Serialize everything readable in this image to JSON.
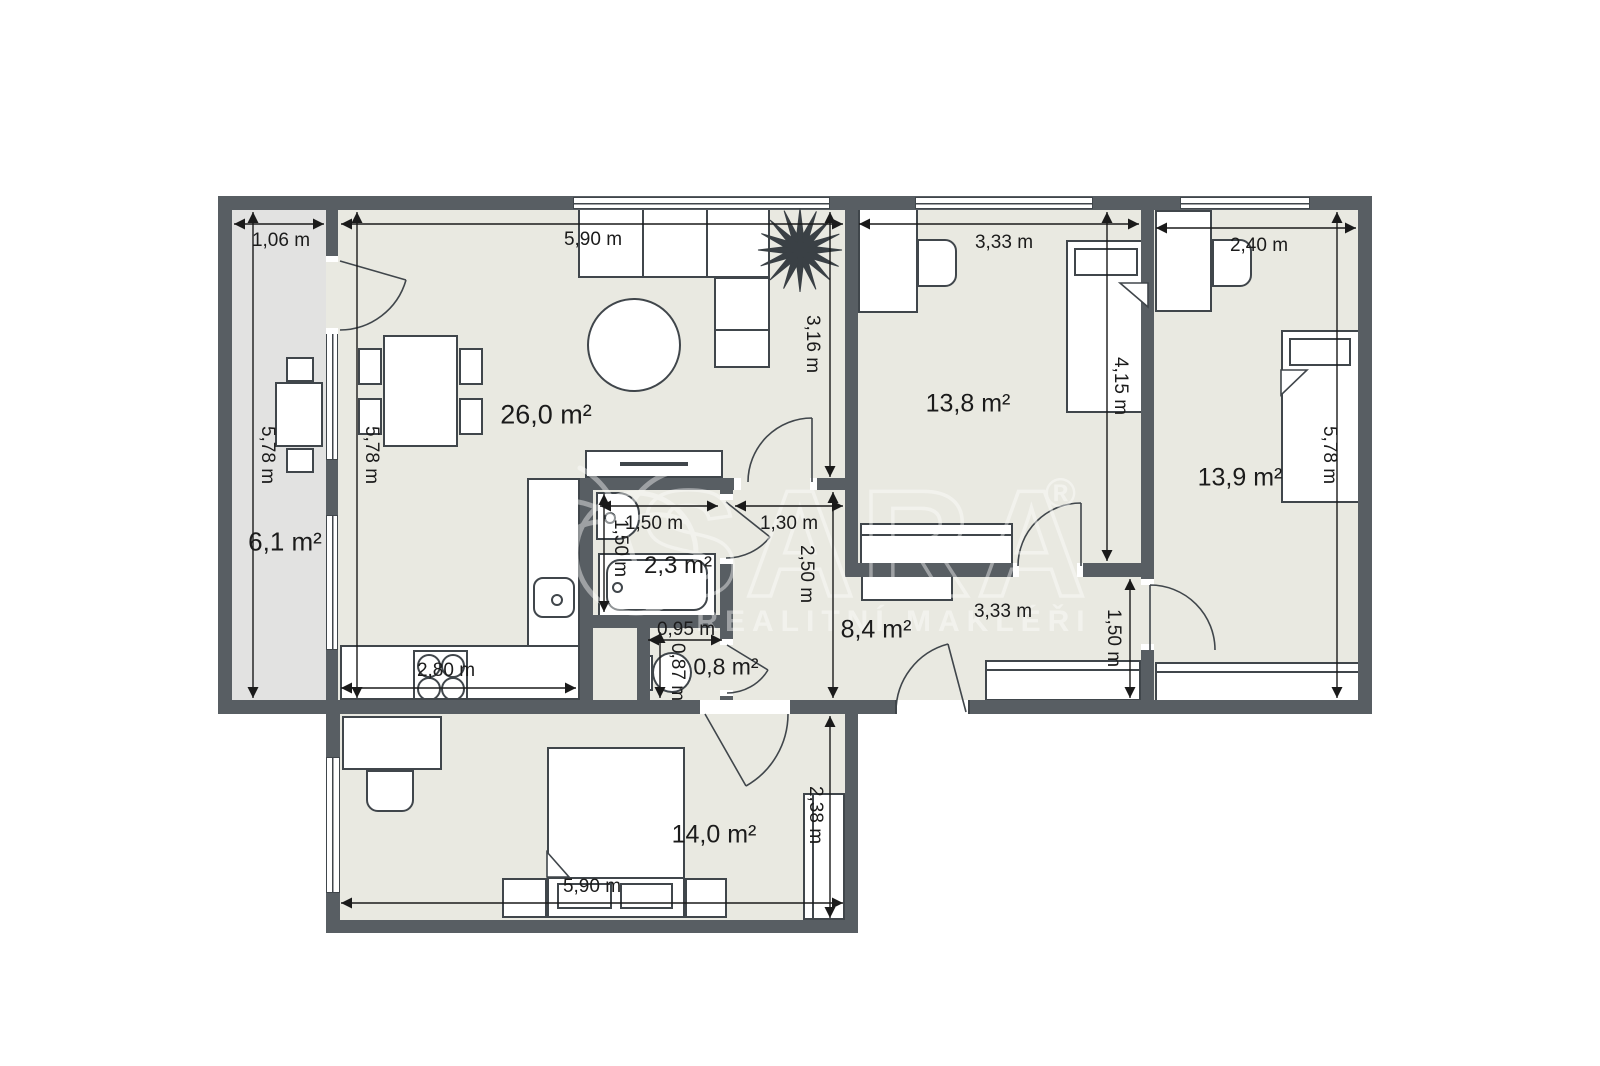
{
  "watermark": {
    "brand": "SARA",
    "registered_mark": "®",
    "tagline": "REALITNÍ MAKLÉŘI"
  },
  "colors": {
    "wall": "#585e63",
    "floor": "#e9e9e1",
    "balcony_floor": "#e2e2e1",
    "furniture_outline": "#40464b",
    "dimension_ink": "#1a1a1a",
    "watermark_ink": "#ffffff",
    "background": "#ffffff"
  },
  "rooms": {
    "balcony": {
      "area": "6,1 m²",
      "dim_width": "1,06 m",
      "dim_height": "5,78 m"
    },
    "living_kitchen": {
      "area": "26,0 m²",
      "dim_width": "5,90 m",
      "dim_height": "5,78 m",
      "dim_right_height": "3,16 m",
      "dim_kitchen_width": "2,80 m"
    },
    "bedroom_top_left": {
      "area": "13,8 m²",
      "dim_width": "3,33 m",
      "dim_height": "4,15 m"
    },
    "bedroom_top_right": {
      "area": "13,9 m²",
      "dim_width": "2,40 m",
      "dim_height": "5,78 m"
    },
    "bathroom": {
      "area": "2,3 m²",
      "dim_width": "1,50 m",
      "dim_height": "1,50 m"
    },
    "wc": {
      "area": "0,8 m²",
      "dim_width": "0,95 m",
      "dim_height": "0,87 m"
    },
    "hall": {
      "area": "8,4 m²",
      "dim_entry_width": "1,30 m",
      "dim_height": "2,50 m",
      "dim_width": "3,33 m",
      "dim_right_height": "1,50 m"
    },
    "bedroom_bottom": {
      "area": "14,0 m²",
      "dim_width": "5,90 m",
      "dim_height": "2,38 m"
    }
  }
}
